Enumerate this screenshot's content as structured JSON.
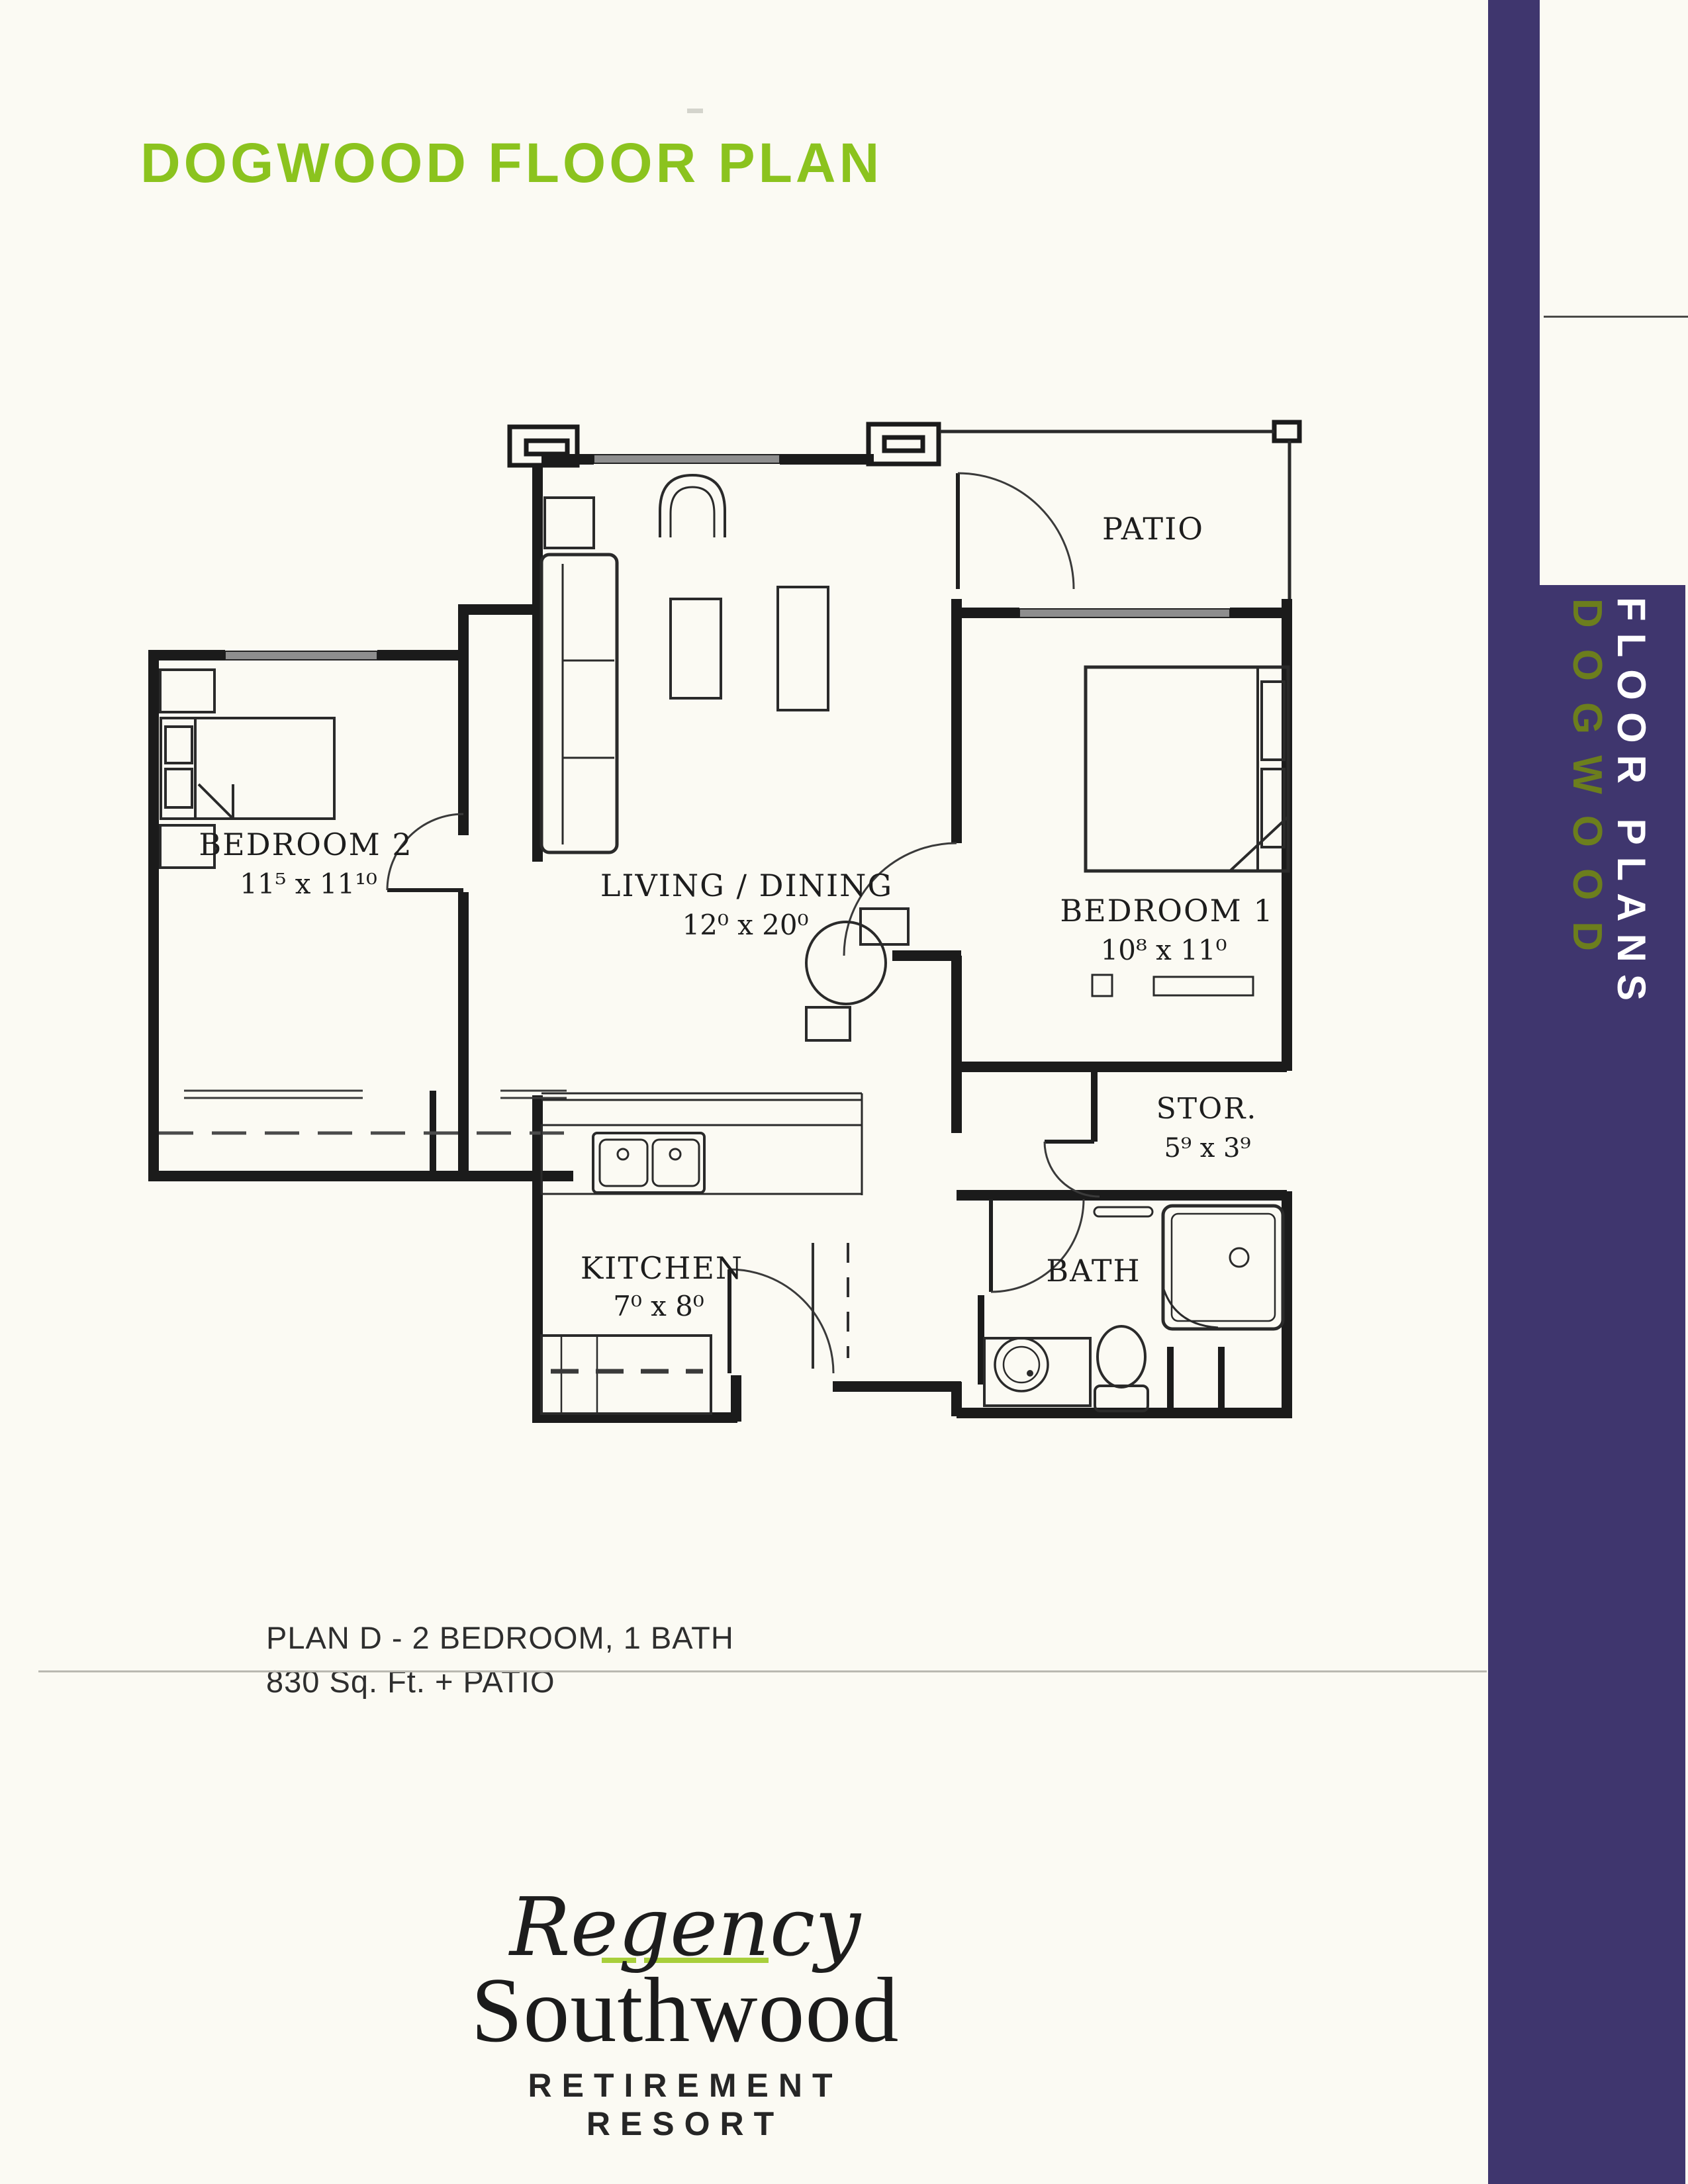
{
  "page": {
    "title": "DOGWOOD FLOOR PLAN"
  },
  "colors": {
    "title_green": "#8bc31e",
    "sidebar_purple": "#3f366e",
    "sidebar_dogwood_green": "#6c7e1d",
    "logo_underline_green": "#a8cf3b",
    "line_art": "#1f1f1f"
  },
  "rooms": {
    "patio": {
      "name": "PATIO"
    },
    "bedroom1": {
      "name": "BEDROOM 1",
      "dims": "10⁸ x 11⁰"
    },
    "bedroom2": {
      "name": "BEDROOM 2",
      "dims": "11⁵ x 11¹⁰"
    },
    "living": {
      "name": "LIVING / DINING",
      "dims": "12⁰ x 20⁰"
    },
    "kitchen": {
      "name": "KITCHEN",
      "dims": "7⁰ x 8⁰"
    },
    "storage": {
      "name": "STOR.",
      "dims": "5⁹ x 3⁹"
    },
    "bath": {
      "name": "BATH"
    }
  },
  "summary": {
    "line1": "PLAN D  -  2 BEDROOM, 1 BATH",
    "line2": "830 Sq. Ft. + PATIO"
  },
  "sidebar": {
    "section": "FLOOR PLANS",
    "page": "DOGWOOD"
  },
  "logo": {
    "script": "Regency",
    "name": "Southwood",
    "tagline": "RETIREMENT RESORT"
  }
}
